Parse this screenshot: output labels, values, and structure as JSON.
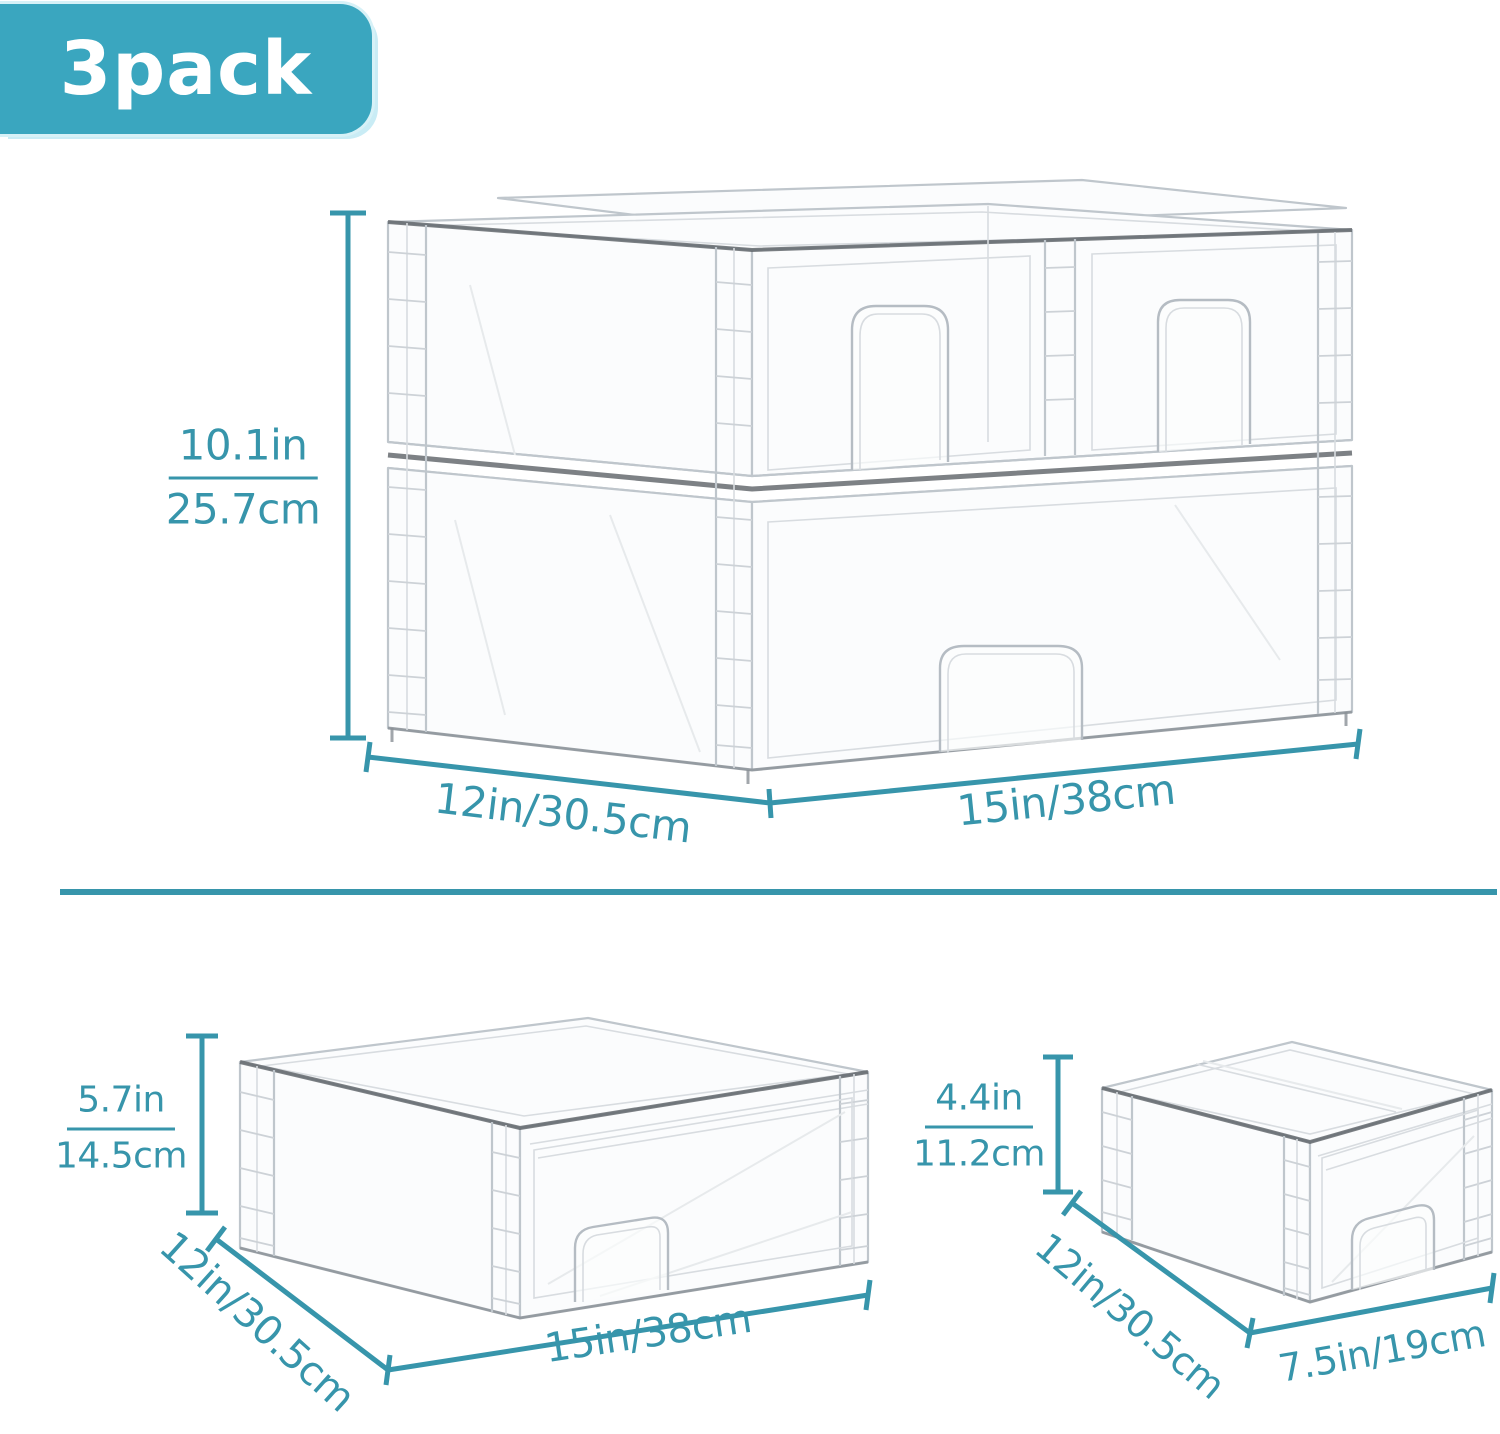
{
  "badge": {
    "label": "3pack"
  },
  "colors": {
    "dimension_teal": "#3795ab",
    "divider_teal": "#3795ab",
    "badge_bg": "#3aa6bf",
    "badge_halo": "#c9ecf5",
    "badge_text": "#ffffff"
  },
  "top_section": {
    "height_in": "10.1in",
    "height_cm": "25.7cm",
    "depth_label": "12in/30.5cm",
    "width_label": "15in/38cm"
  },
  "bottom_left_section": {
    "height_in": "5.7in",
    "height_cm": "14.5cm",
    "depth_label": "12in/30.5cm",
    "width_label": "15in/38cm"
  },
  "bottom_right_section": {
    "height_in": "4.4in",
    "height_cm": "11.2cm",
    "depth_label": "12in/30.5cm",
    "width_label": "7.5in/19cm"
  }
}
